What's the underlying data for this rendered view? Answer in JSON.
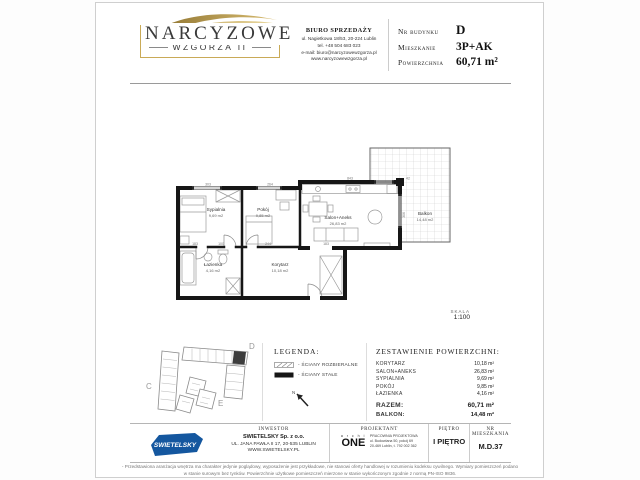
{
  "brand": {
    "name": "NARCYZOWE",
    "subname": "WZGÓRZA II"
  },
  "office": {
    "title": "BIURO SPRZEDAŻY",
    "address": "ul. Nagietkowa 18/53, 20-224 Lublin",
    "phone": "tel. +48 504 683 023",
    "email": "e-mail: biuro@narcyzowewzgorza.pl",
    "web": "www.narcyzowewzgorza.pl"
  },
  "unit_info": {
    "building": {
      "label": "Nr budynku",
      "value": "D"
    },
    "apartment": {
      "label": "Mieszkanie",
      "value": "3P+AK"
    },
    "area": {
      "label": "Powierzchnia",
      "value": "60,71 m²"
    }
  },
  "plan": {
    "rooms": {
      "sypialnia": {
        "name": "Sypialnia",
        "area": "9,69 m2"
      },
      "pokoj": {
        "name": "Pokój",
        "area": "9,85 m2"
      },
      "lazienka": {
        "name": "Łazienka",
        "area": "4,16 m2"
      },
      "korytarz": {
        "name": "Korytarz",
        "area": "10,18 m2"
      },
      "salon": {
        "name": "Salon+Aneks",
        "area": "26,83 m2"
      },
      "balkon": {
        "name": "Balkon",
        "area": "14,48 m2"
      }
    },
    "dims": [
      "303",
      "264",
      "843",
      "42",
      "306",
      "183",
      "100",
      "244",
      "183"
    ]
  },
  "legend": {
    "title": "LEGENDA:",
    "items": [
      {
        "label": "- ŚCIANY ROZBIERALNE"
      },
      {
        "label": "- ŚCIANY STAŁE"
      }
    ]
  },
  "site_plan": {
    "buildings": {
      "c": "C",
      "d": "D",
      "e": "E"
    }
  },
  "scale": {
    "label": "SKALA",
    "value": "1:100"
  },
  "areas_table": {
    "title": "ZESTAWIENIE POWIERZCHNI:",
    "rows": [
      {
        "name": "KORYTARZ",
        "value": "10,18 m²"
      },
      {
        "name": "SALON+ANEKS",
        "value": "26,83 m²"
      },
      {
        "name": "SYPIALNIA",
        "value": "9,69 m²"
      },
      {
        "name": "POKÓJ",
        "value": "9,85 m²"
      },
      {
        "name": "ŁAZIENKA",
        "value": "4,16 m²"
      }
    ],
    "total": {
      "name": "RAZEM:",
      "value": "60,71 m²"
    },
    "balcony": {
      "name": "BALKON:",
      "value": "14,48 m²"
    }
  },
  "footer": {
    "investor": {
      "label": "INWESTOR",
      "logo_text": "SWIETELSKY",
      "line1": "SWIETELSKY Sp. z o.o.",
      "line2": "UL. JANA PAWŁA II 17, 20-535 LUBLIN",
      "line3": "WWW.SWIETELSKY.PL"
    },
    "designer": {
      "label": "PROJEKTANT",
      "logo_top": "a r c h i",
      "logo_main": "ONE",
      "line1": "PRACOWNIA PROJEKTOWA",
      "line2": "ul. Budowlana 50, pokój 69",
      "line3": "20-469 Lublin, t. 792 002 362"
    },
    "floor": {
      "label": "PIĘTRO",
      "value": "I PIĘTRO"
    },
    "unit": {
      "label": "NR MIESZKANIA",
      "value": "M.D.37"
    }
  },
  "disclaimer": {
    "text": "- Przedstawiona aranżacja wnętrza ma charakter jedynie poglądowy, wyposażenie jest przykładowe, nie stanowi oferty handlowej w rozumieniu kodeksu cywilnego. Wymiary pomieszczeń podano w stanie surowym bez tynków. Powierzchnie użytkowe pomieszczeń mierzone w stanie wykończonym zgodnie z normą PN-ISO 9836."
  }
}
